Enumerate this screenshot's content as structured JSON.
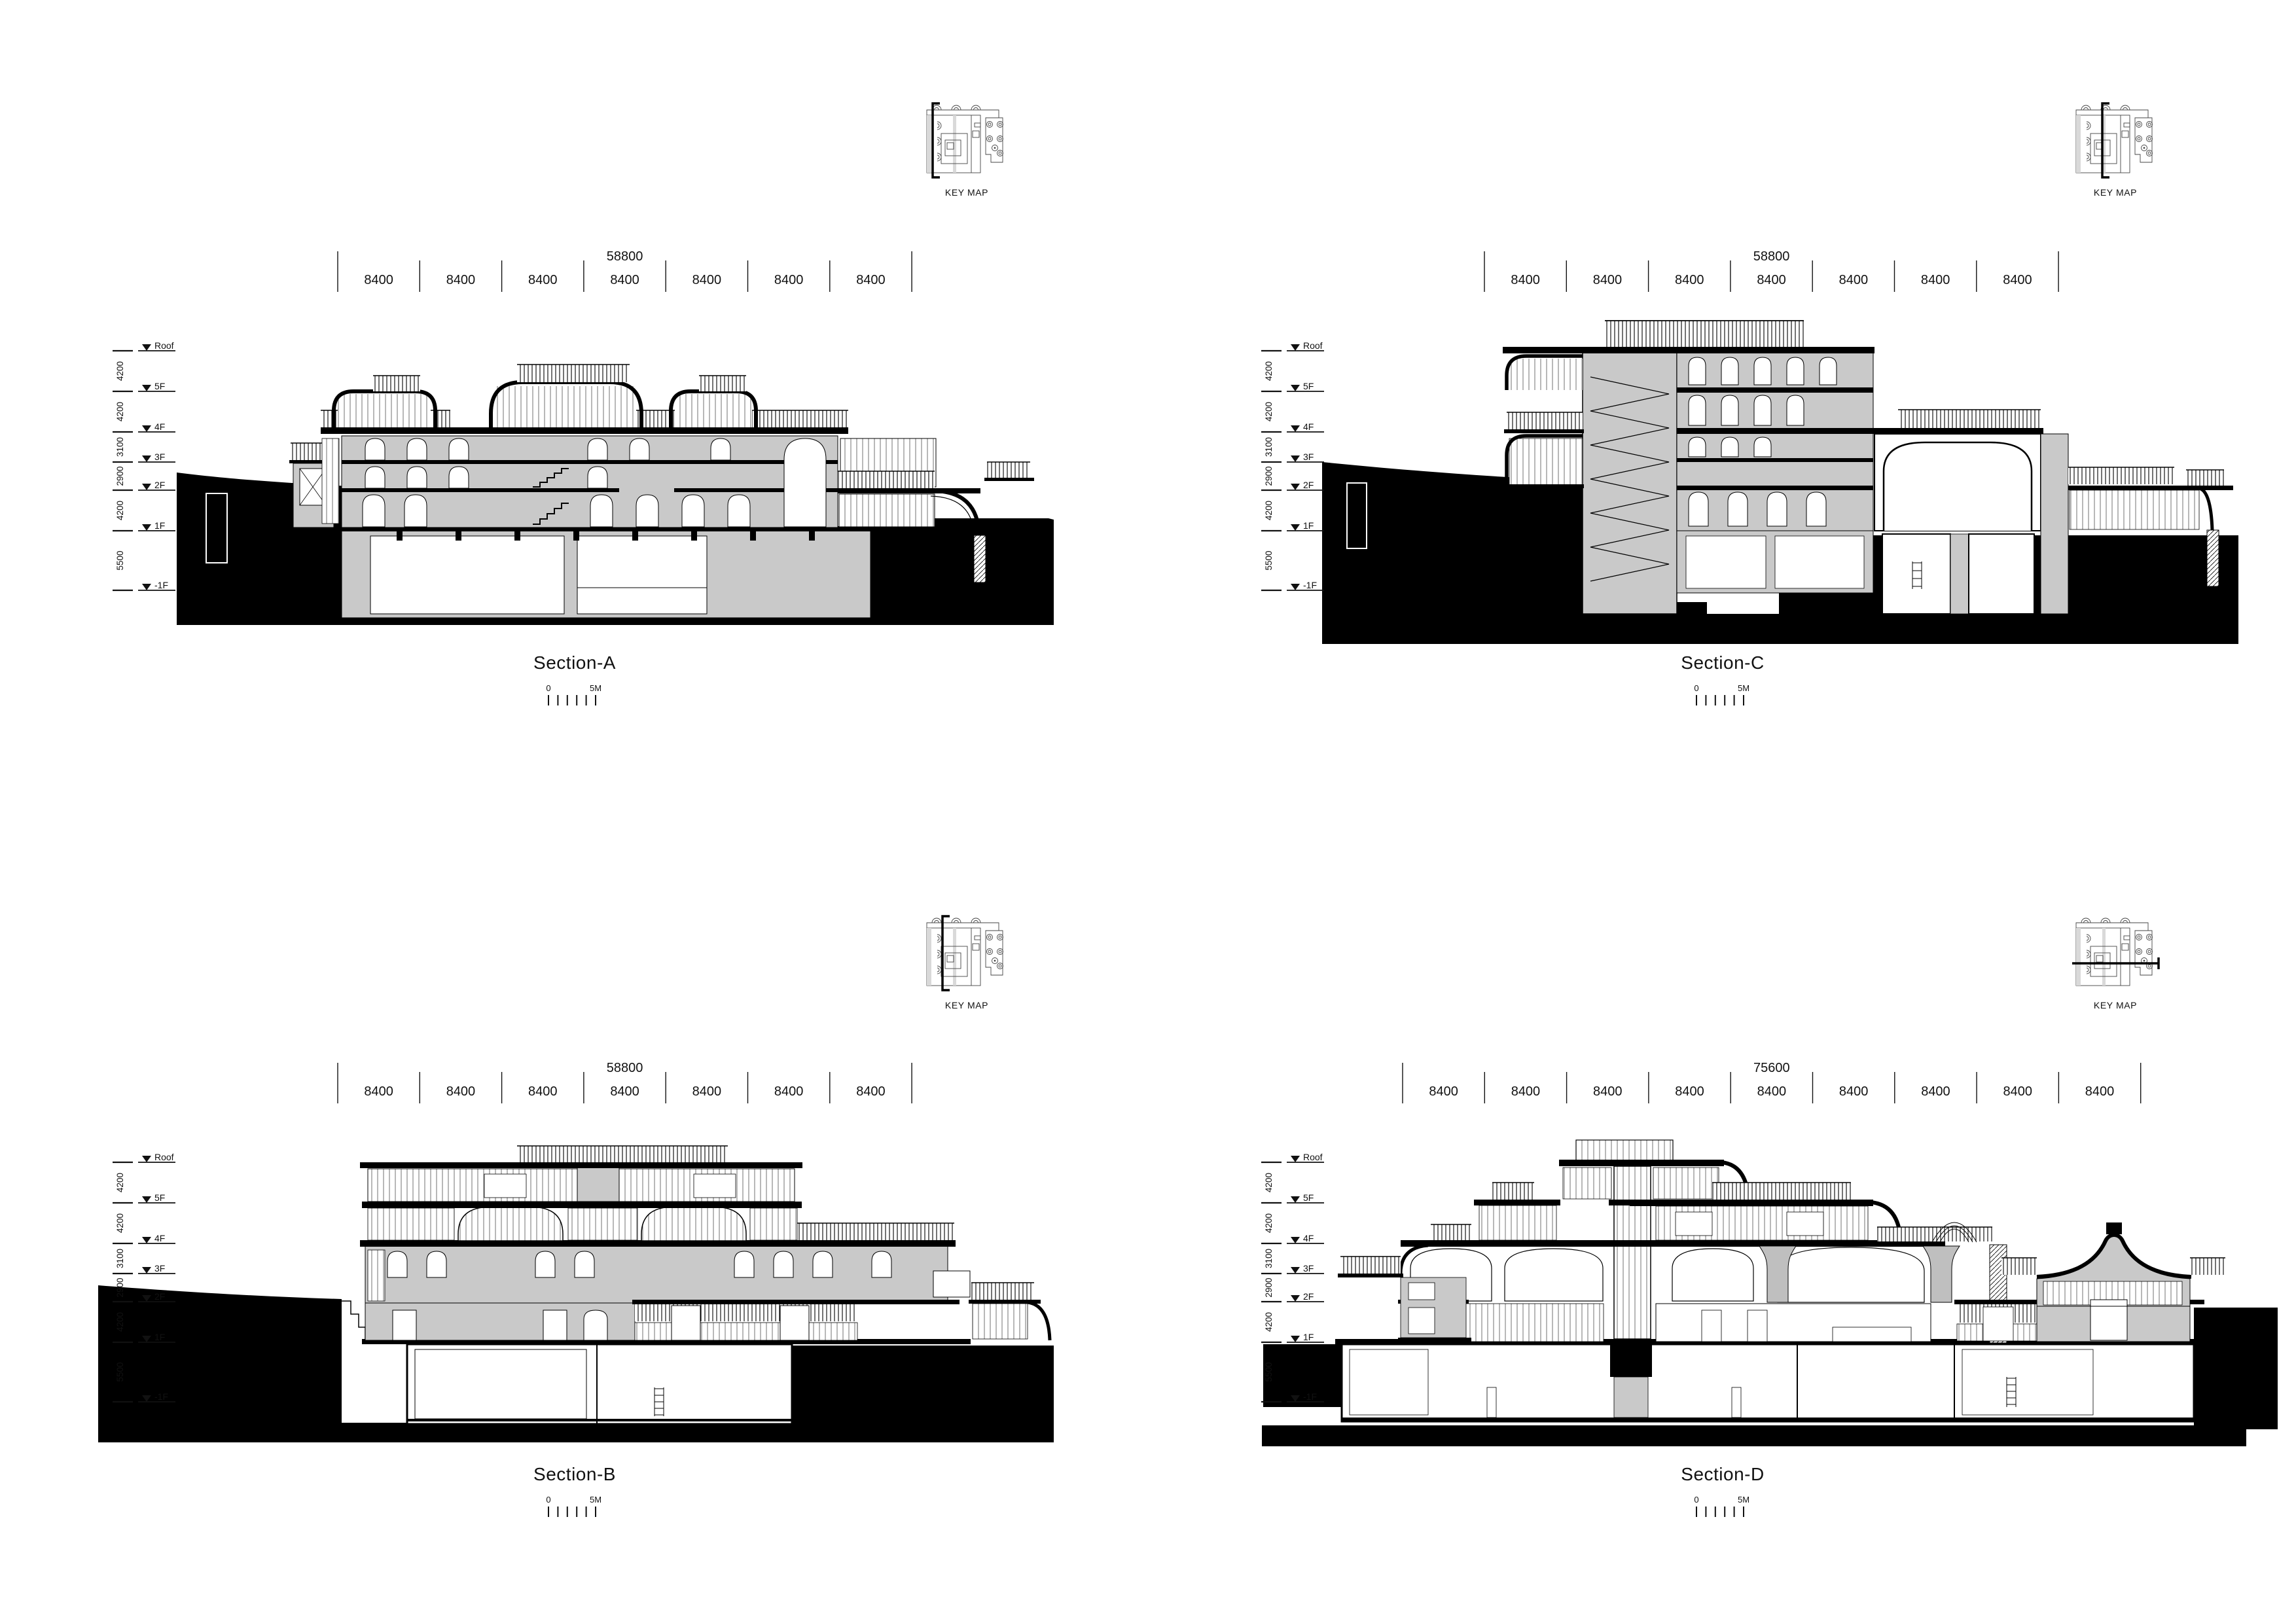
{
  "sheet": {
    "kind": "architectural-sections-sheet"
  },
  "colors": {
    "ink": "#000000",
    "paper": "#ffffff",
    "poche": "#c9c9c9",
    "glazing_line": "#707070"
  },
  "levels": {
    "names": [
      "Roof",
      "5F",
      "4F",
      "3F",
      "2F",
      "1F",
      "-1F"
    ],
    "spacings": [
      "4200",
      "4200",
      "3100",
      "2900",
      "4200",
      "5500"
    ]
  },
  "scale_bar": {
    "start_label": "0",
    "end_label": "5M",
    "tick_count": 6
  },
  "key_map": {
    "label": "KEY MAP"
  },
  "sections": [
    {
      "id": "A",
      "title": "Section-A",
      "overall_dim": "58800",
      "bay_dims": [
        "8400",
        "8400",
        "8400",
        "8400",
        "8400",
        "8400",
        "8400"
      ]
    },
    {
      "id": "C",
      "title": "Section-C",
      "overall_dim": "58800",
      "bay_dims": [
        "8400",
        "8400",
        "8400",
        "8400",
        "8400",
        "8400",
        "8400"
      ]
    },
    {
      "id": "B",
      "title": "Section-B",
      "overall_dim": "58800",
      "bay_dims": [
        "8400",
        "8400",
        "8400",
        "8400",
        "8400",
        "8400",
        "8400"
      ]
    },
    {
      "id": "D",
      "title": "Section-D",
      "overall_dim": "75600",
      "bay_dims": [
        "8400",
        "8400",
        "8400",
        "8400",
        "8400",
        "8400",
        "8400",
        "8400",
        "8400"
      ]
    }
  ]
}
